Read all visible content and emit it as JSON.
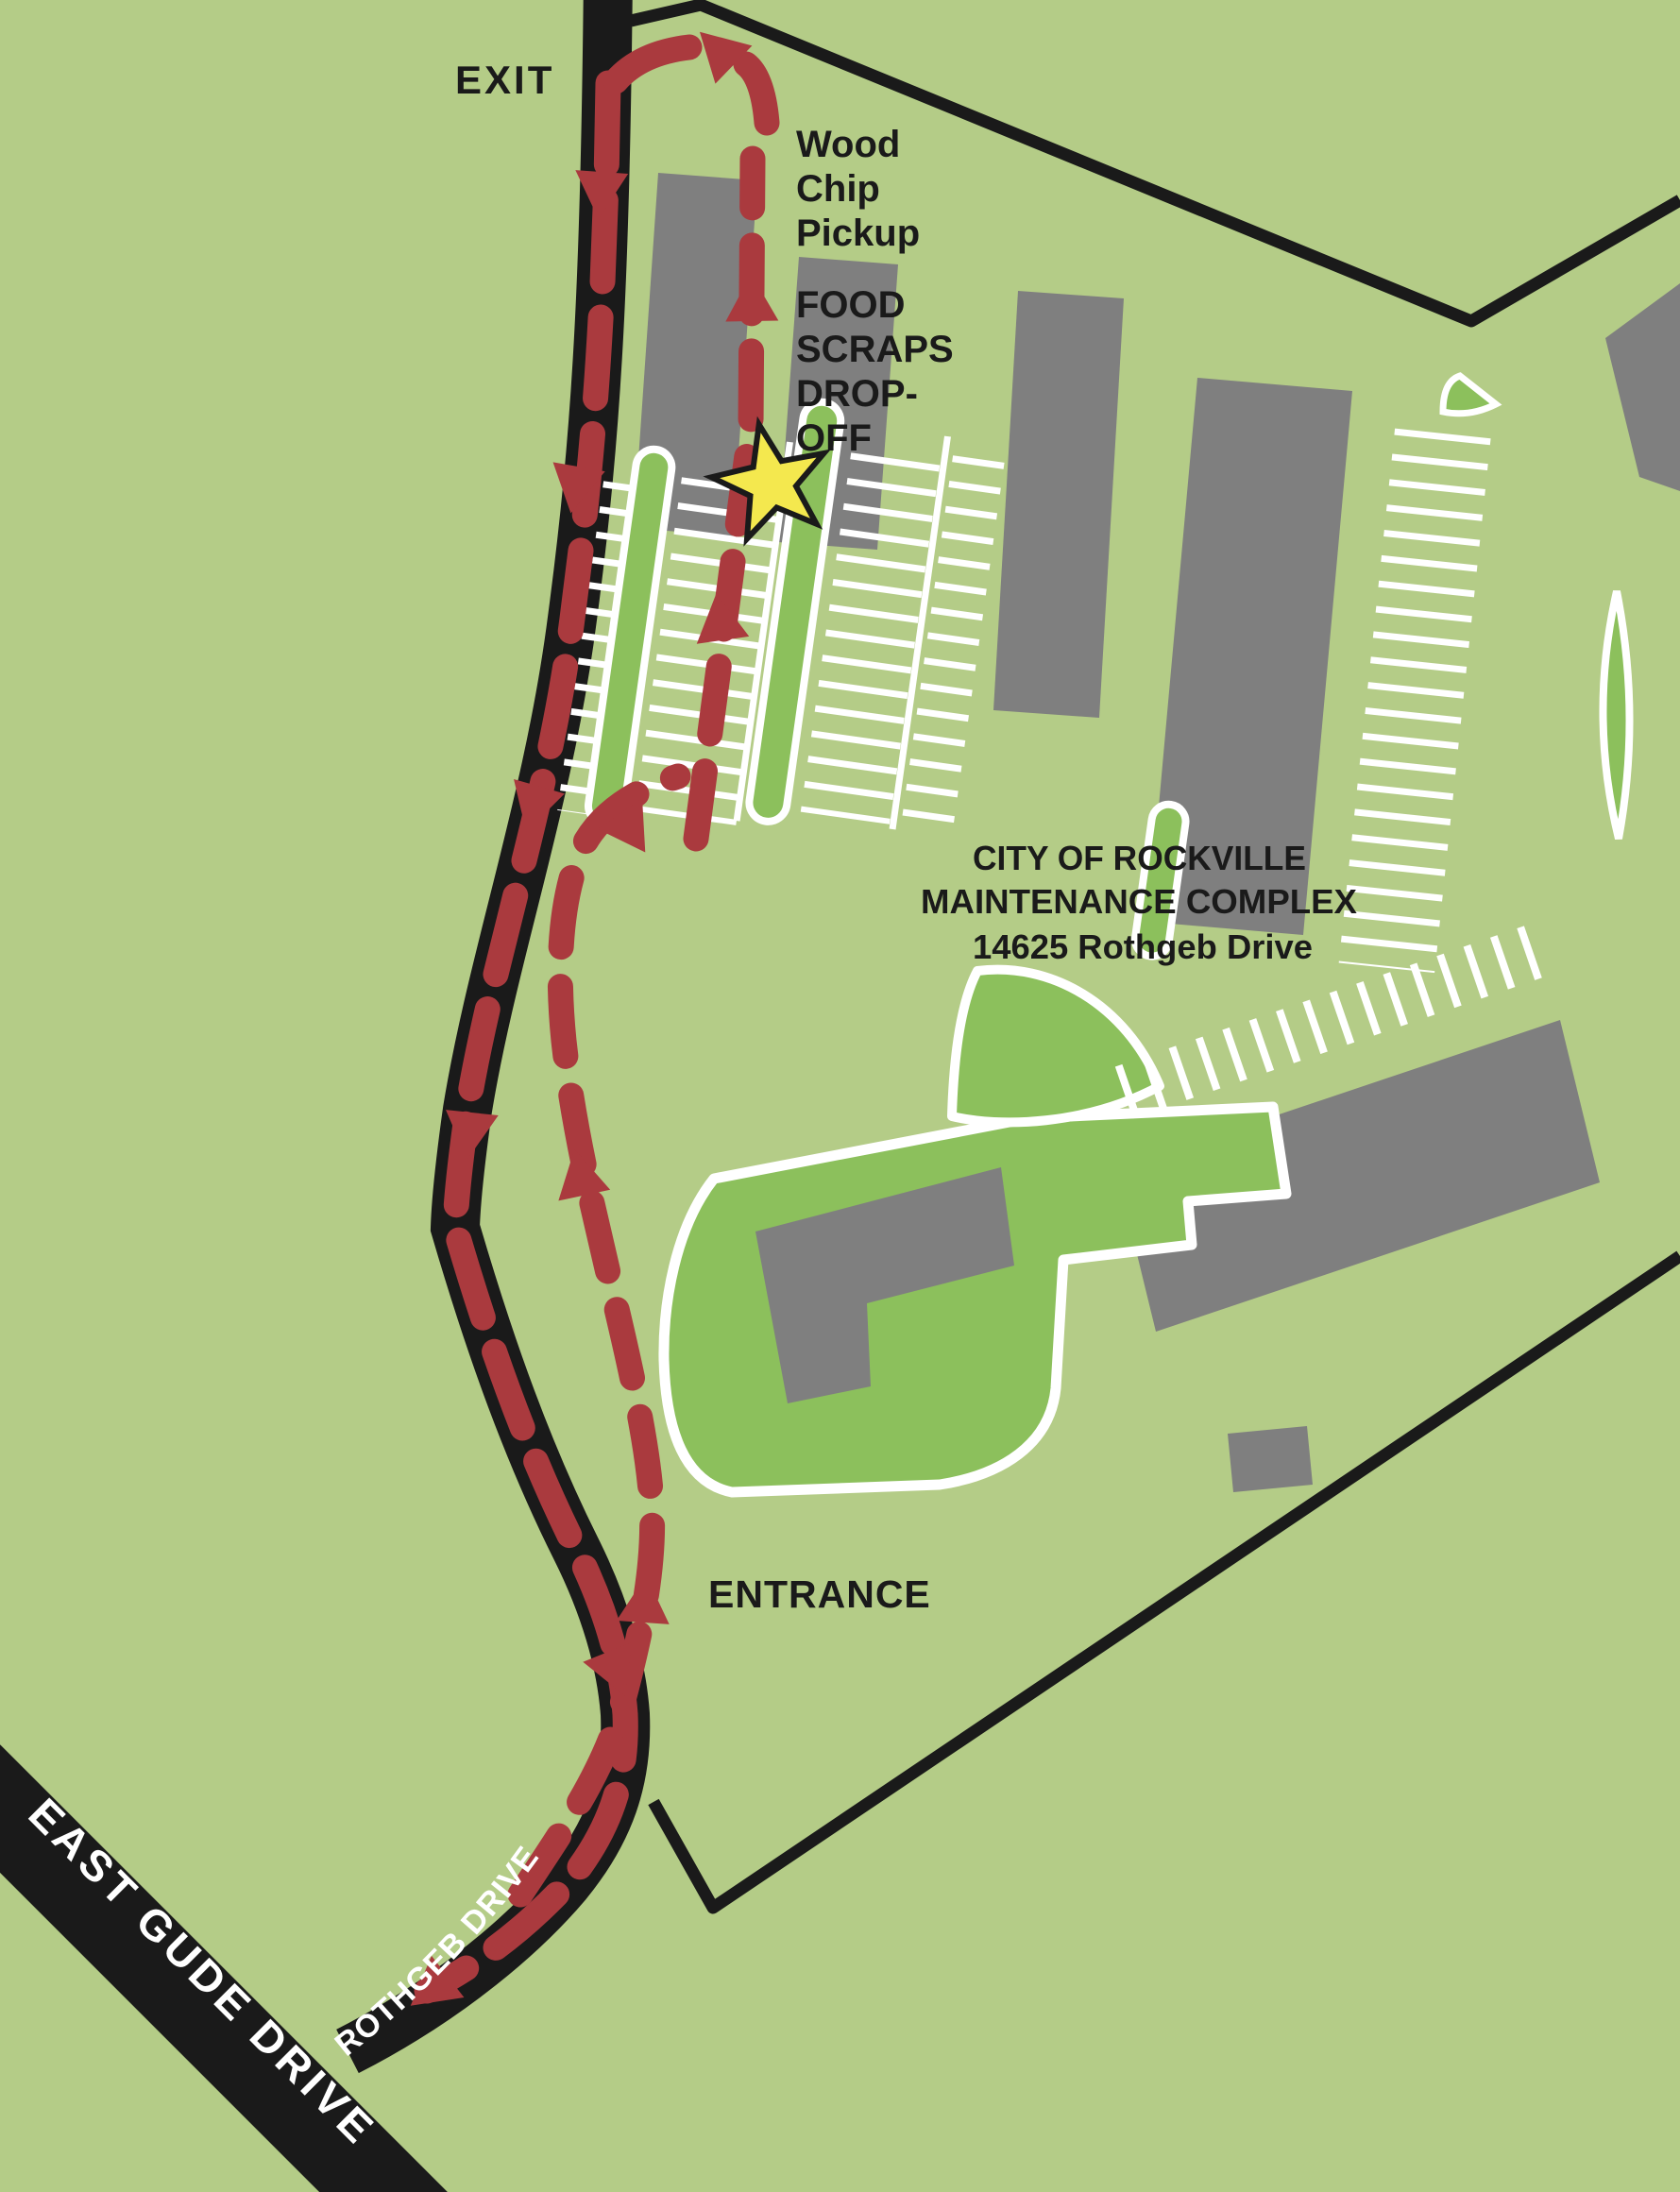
{
  "map": {
    "labels": {
      "exit": "EXIT",
      "wood_chip_line1": "Wood",
      "wood_chip_line2": "Chip",
      "wood_chip_line3": "Pickup",
      "food_line1": "FOOD",
      "food_line2": "SCRAPS",
      "food_line3": "DROP-",
      "food_line4": "OFF",
      "entrance": "ENTRANCE"
    },
    "title_block": {
      "line1": "CITY OF ROCKVILLE",
      "line2": "MAINTENANCE COMPLEX",
      "line3": "14625 Rothgeb Drive"
    },
    "roads": {
      "east_gude": "EAST GUDE DRIVE",
      "rothgeb": "ROTHGEB DRIVE"
    },
    "icons": {
      "star": "drop-off-location-star"
    },
    "colors": {
      "background_green": "#b4cc87",
      "island_green": "#8cc05c",
      "building_gray": "#7f7f7f",
      "road_black": "#1a1a1a",
      "route_red": "#aa3a3e",
      "star_yellow": "#f4e84e",
      "hatch_white": "#ffffff"
    }
  }
}
